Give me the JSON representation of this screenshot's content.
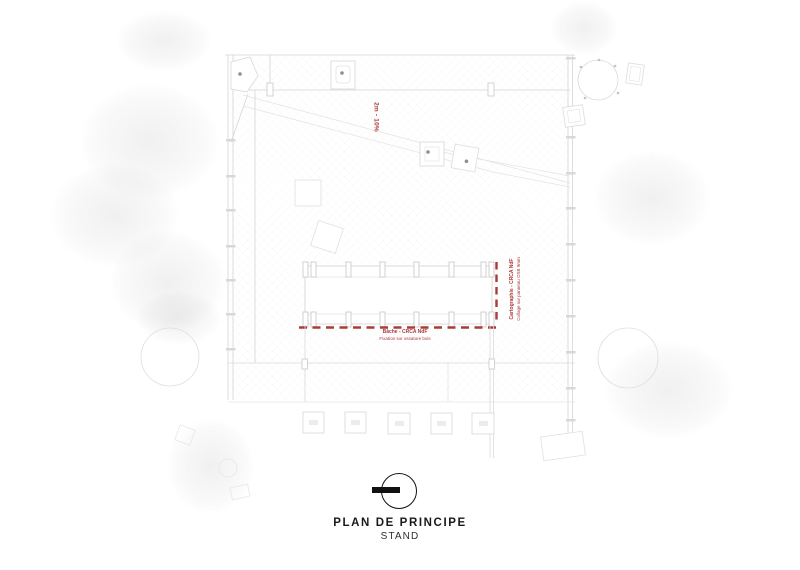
{
  "annotations": {
    "ramp_label": "2m - 10%",
    "side_note": {
      "line1": "Cartographie - CRCA NdF",
      "line2": "Collage sur panneau OSB 9mm"
    },
    "bottom_note": {
      "line1": "Bâche - CRCA NdF",
      "line2": "Fixation sur ossature bois"
    }
  },
  "title_block": {
    "title": "PLAN DE PRINCIPE",
    "subtitle": "STAND"
  },
  "colors": {
    "annotation_red": "#a93b38",
    "line_gray": "#d9d9d9",
    "ink": "#111111"
  }
}
